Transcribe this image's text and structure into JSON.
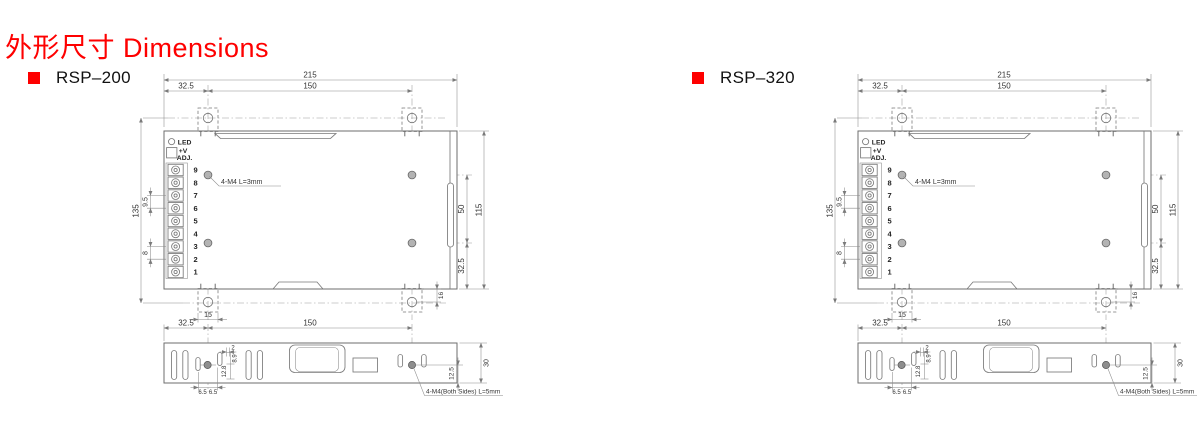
{
  "page": {
    "title": "外形尺寸 Dimensions",
    "accent_color": "#fe0000",
    "line_color": "#6e6e6e",
    "background": "#ffffff"
  },
  "panels": [
    {
      "model": "RSP–200"
    },
    {
      "model": "RSP–320"
    }
  ],
  "drawing": {
    "top_view": {
      "width_total": "215",
      "hole_offset_x": "32.5",
      "hole_spacing_x": "150",
      "height_total": "135",
      "terminal_pitch": "9.5",
      "terminal_pitch_small": "8",
      "led_label": "LED",
      "adj_label_line1": "+V",
      "adj_label_line2": "ADJ.",
      "terminal_numbers": [
        "9",
        "8",
        "7",
        "6",
        "5",
        "4",
        "3",
        "2",
        "1"
      ],
      "mounting_note": "4-M4 L=3mm",
      "hole_spacing_y": "50",
      "height_inner": "115",
      "hole_bottom_offset": "32.5",
      "bracket_hole_offset": "16",
      "bracket_width": "15"
    },
    "side_view": {
      "hole_offset_x": "32.5",
      "hole_spacing_x": "150",
      "slot_offset": "2",
      "slot_top_offset": "8.9",
      "slot_height": "12.8",
      "hole_pitch_left": "6.5",
      "hole_pitch_right": "6.5",
      "height_total": "30",
      "hole_bottom_offset": "12.5",
      "mounting_note": "4-M4(Both Sides) L=5mm"
    }
  }
}
